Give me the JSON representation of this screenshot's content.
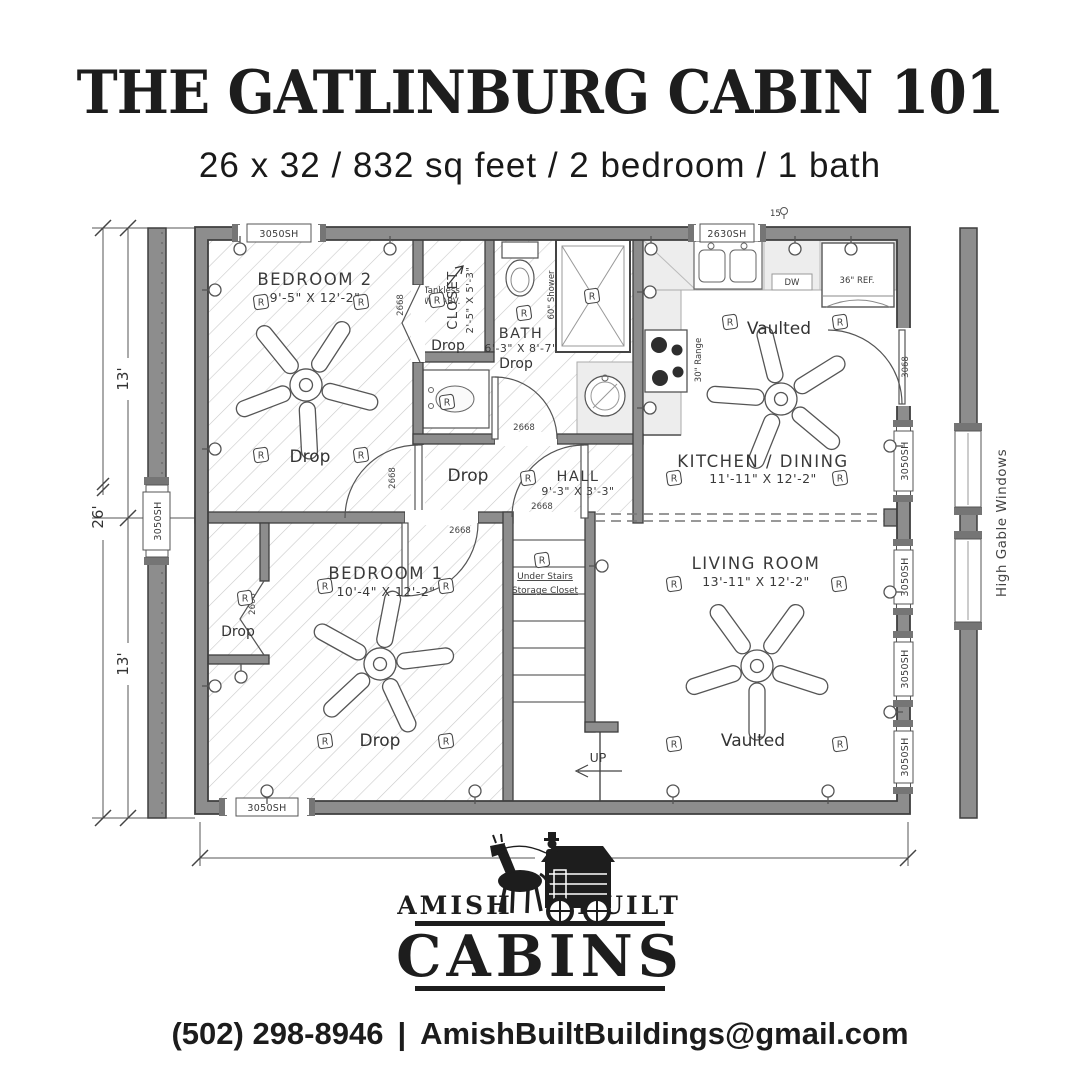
{
  "header": {
    "title": "THE GATLINBURG CABIN 101",
    "subtitle": "26 x 32 / 832 sq feet / 2 bedroom / 1 bath"
  },
  "plan": {
    "rooms": {
      "bedroom2": {
        "name": "BEDROOM 2",
        "dims": "9'-5\" X 12'-2\""
      },
      "closet": {
        "name": "CLOSET",
        "dims": "2'-5\" X 5'-3\""
      },
      "bath": {
        "name": "BATH",
        "dims": "6'-3\" X 8'-7\""
      },
      "hall": {
        "name": "HALL",
        "dims": "9'-3\" X 3'-3\""
      },
      "kitchen": {
        "name": "KITCHEN / DINING",
        "dims": "11'-11\" X 12'-2\""
      },
      "living": {
        "name": "LIVING ROOM",
        "dims": "13'-11\" X 12'-2\""
      },
      "bedroom1": {
        "name": "BEDROOM 1",
        "dims": "10'-4\" X 12'-2\""
      }
    },
    "labels": {
      "drop": "Drop",
      "vaulted": "Vaulted",
      "up": "UP",
      "under_stairs_1": "Under Stairs",
      "under_stairs_2": "Storage Closet",
      "tankless_1": "Tankless",
      "tankless_2": "WH ABV.",
      "shower": "60\" Shower",
      "range": "30\" Range",
      "fridge": "36\" REF.",
      "dishwasher": "DW",
      "high_gable": "High Gable Windows",
      "recessed": "R",
      "ceiling_note": "15"
    },
    "windows": {
      "sh3050": "3050SH",
      "sh2630": "2630SH"
    },
    "doors": {
      "d2668": "2668",
      "d3068": "3068"
    },
    "dimensions": {
      "width": "32'",
      "height": "26'",
      "half_upper": "13'",
      "half_lower": "13'"
    }
  },
  "logo": {
    "left": "AMISH",
    "right": "BUILT",
    "main": "CABINS"
  },
  "contact": {
    "phone": "(502) 298-8946",
    "separator": "|",
    "email": "AmishBuiltBuildings@gmail.com"
  },
  "colors": {
    "ink": "#1d1d1d",
    "wall": "#8d8d8d",
    "hatch": "#c9c9c9"
  }
}
